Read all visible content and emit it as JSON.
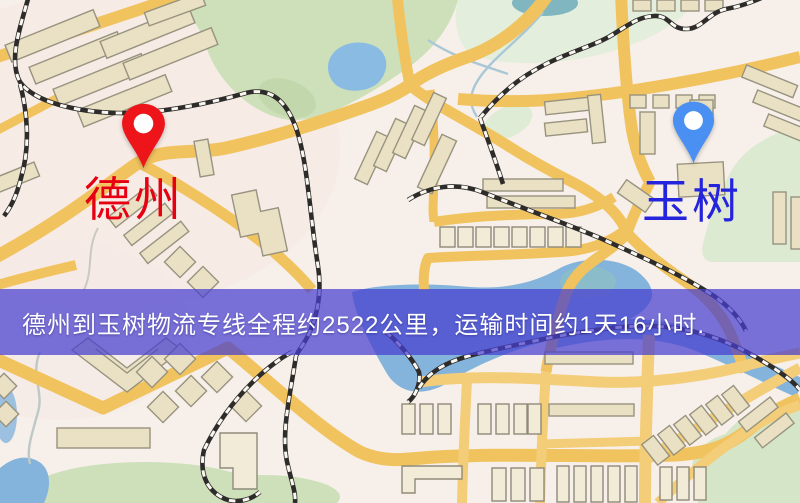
{
  "map": {
    "banner": {
      "text": "德州到玉树物流专线全程约2522公里，运输时间约1天16小时.",
      "background_color": "#4a43d0",
      "text_color": "#ffffff"
    },
    "markers": {
      "origin": {
        "label": "德州",
        "label_color": "#e60012",
        "pin_color": "#ed1519"
      },
      "destination": {
        "label": "玉树",
        "label_color": "#2424dc",
        "pin_color": "#4a8ff2"
      }
    },
    "palette": {
      "land": "#f7efe9",
      "road": "#f1c35f",
      "building": "#eae1c4",
      "park": "#cde0ba",
      "water": "#84b4dc",
      "railway": "#2e2c2a"
    }
  }
}
